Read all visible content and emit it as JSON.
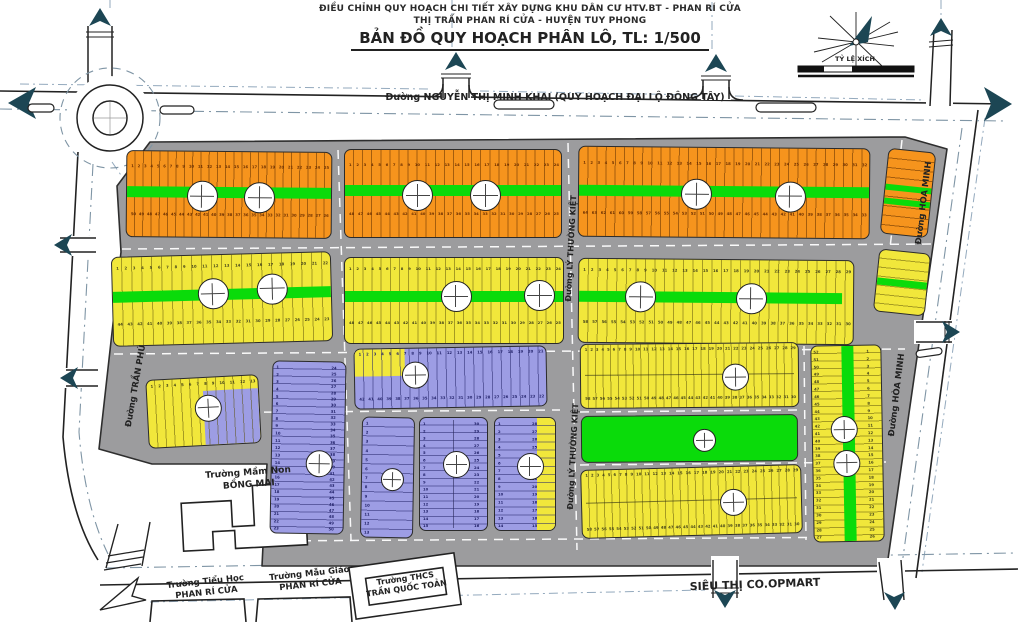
{
  "header": {
    "line1": "ĐIỀU CHỈNH QUY HOẠCH CHI TIẾT XÂY DỰNG KHU DÂN CƯ HTV.BT - PHAN RÍ CỬA",
    "line2": "THỊ TRẤN PHAN RÍ CỬA - HUYỆN TUY PHONG",
    "line3": "BẢN ĐỒ QUY HOẠCH PHÂN LÔ, TL: 1/500"
  },
  "compass": {
    "scale_label": "TỶ LỆ XÍCH"
  },
  "roads": {
    "main_east_west": "Đường NGUYỄN THỊ MINH KHAI (QUY HOẠCH ĐẠI LỘ ĐÔNG TÂY)",
    "tran_phu": "Đường TRẦN PHÚ",
    "hoa_minh_upper": "Đường HÒA MINH",
    "hoa_minh_lower": "Đường HÒA MINH",
    "ly_thuong_kiet_upper": "Đường LÝ THƯỜNG KIỆT",
    "ly_thuong_kiet_lower": "Đường LÝ THƯỜNG KIỆT"
  },
  "facilities": {
    "mam_non": {
      "line1": "Trường Mầm Non",
      "line2": "BỒNG MAI"
    },
    "tieu_hoc": {
      "line1": "Trường Tiểu Học",
      "line2": "PHAN RÍ CỬA"
    },
    "mau_giao": {
      "line1": "Trường Mẫu Giáo",
      "line2": "PHAN RÍ CỬA"
    },
    "thcs": {
      "line1": "Trường THCS",
      "line2": "TRẦN QUỐC TOẢN"
    },
    "sieu_thi": "SIÊU THỊ CO.OPMART"
  },
  "colors": {
    "orange": "#F6941D",
    "yellow": "#F1E73B",
    "purple": "#9D9DE4",
    "green": "#0ADB0A",
    "road_gray": "#9C9C9E",
    "outline": "#2E2E2E",
    "arrow": "#1C4654",
    "dash_blue": "#93A9BD"
  },
  "blocks": [
    {
      "id": "A1",
      "fill": "orange",
      "kind": "parcels",
      "green_strip": true,
      "parcels_top": {
        "from": 1,
        "to": 25
      },
      "parcels_bottom": {
        "from": 50,
        "to": 26
      },
      "markers": 2
    },
    {
      "id": "A2",
      "fill": "orange",
      "kind": "parcels",
      "green_strip": true,
      "parcels_top": {
        "from": 1,
        "to": 24
      },
      "parcels_bottom": {
        "from": 48,
        "to": 25
      },
      "markers": 2
    },
    {
      "id": "A3",
      "fill": "orange",
      "kind": "parcels",
      "green_strip": true,
      "parcels_top": {
        "from": 1,
        "to": 32
      },
      "parcels_bottom": {
        "from": 64,
        "to": 33
      },
      "markers": 2
    },
    {
      "id": "A4",
      "fill": "orange",
      "kind": "parcels",
      "green_strip": true,
      "tick_count": 9,
      "markers": 0
    },
    {
      "id": "B1",
      "fill": "yellow",
      "kind": "parcels",
      "green_strip": true,
      "parcels_top": {
        "from": 1,
        "to": 22
      },
      "parcels_bottom": {
        "from": 44,
        "to": 23
      },
      "markers": 2
    },
    {
      "id": "B2",
      "fill": "yellow",
      "kind": "parcels",
      "green_strip": true,
      "parcels_top": {
        "from": 1,
        "to": 24
      },
      "parcels_bottom": {
        "from": 48,
        "to": 25
      },
      "markers": 2
    },
    {
      "id": "B3",
      "fill": "yellow",
      "kind": "parcels",
      "green_strip": true,
      "parcels_top": {
        "from": 1,
        "to": 29
      },
      "parcels_bottom": {
        "from": 58,
        "to": 30
      },
      "markers": 2
    },
    {
      "id": "B4",
      "fill": "yellow",
      "kind": "parcels",
      "green_strip": true,
      "tick_count": 7,
      "markers": 0
    },
    {
      "id": "M1",
      "fill": "purple",
      "kind": "parcels",
      "green_strip": false,
      "parcels_top": {
        "from": 1,
        "to": 21
      },
      "parcels_bottom": {
        "from": 42,
        "to": 22
      },
      "markers": 1
    },
    {
      "id": "Y5",
      "fill": "yellow",
      "kind": "parcels",
      "green_strip": false,
      "parcels_top": {
        "from": 1,
        "to": 29
      },
      "parcels_bottom": {
        "from": 58,
        "to": 30
      },
      "markers": 1
    },
    {
      "id": "PK",
      "fill": "green",
      "kind": "park",
      "green_strip": false,
      "markers": 1
    },
    {
      "id": "Y6",
      "fill": "yellow",
      "kind": "parcels",
      "green_strip": false,
      "parcels_top": {
        "from": 1,
        "to": 29
      },
      "parcels_bottom": {
        "from": 58,
        "to": 30
      },
      "markers": 1
    },
    {
      "id": "Y7",
      "fill": "yellow",
      "kind": "parcels",
      "green_strip": true,
      "parcels_left": {
        "from": 52,
        "to": 27
      },
      "parcels_right": {
        "from": 1,
        "to": 26
      },
      "markers": 2
    },
    {
      "id": "P1",
      "fill": "purple",
      "kind": "parcels",
      "green_strip": false,
      "parcels_left": {
        "from": 1,
        "to": 23
      },
      "parcels_right": {
        "from": 24,
        "to": 50
      },
      "markers": 1
    },
    {
      "id": "P2",
      "fill": "purple",
      "kind": "parcels",
      "green_strip": false,
      "parcels_left": {
        "from": 1,
        "to": 13
      },
      "markers": 1
    },
    {
      "id": "P3",
      "fill": "purple",
      "kind": "parcels",
      "green_strip": false,
      "parcels_left": {
        "from": 1,
        "to": 15
      },
      "parcels_right": {
        "from": 30,
        "to": 16
      },
      "markers": 1
    },
    {
      "id": "P4",
      "fill": "purple",
      "kind": "parcels",
      "green_strip": false,
      "parcels_left": {
        "from": 1,
        "to": 14
      },
      "parcels_right": {
        "from": 28,
        "to": 15
      },
      "markers": 1
    },
    {
      "id": "W1",
      "fill": "yellow",
      "kind": "parcels",
      "green_strip": false,
      "parcels_top": {
        "from": 1,
        "to": 13
      },
      "markers": 1
    }
  ]
}
